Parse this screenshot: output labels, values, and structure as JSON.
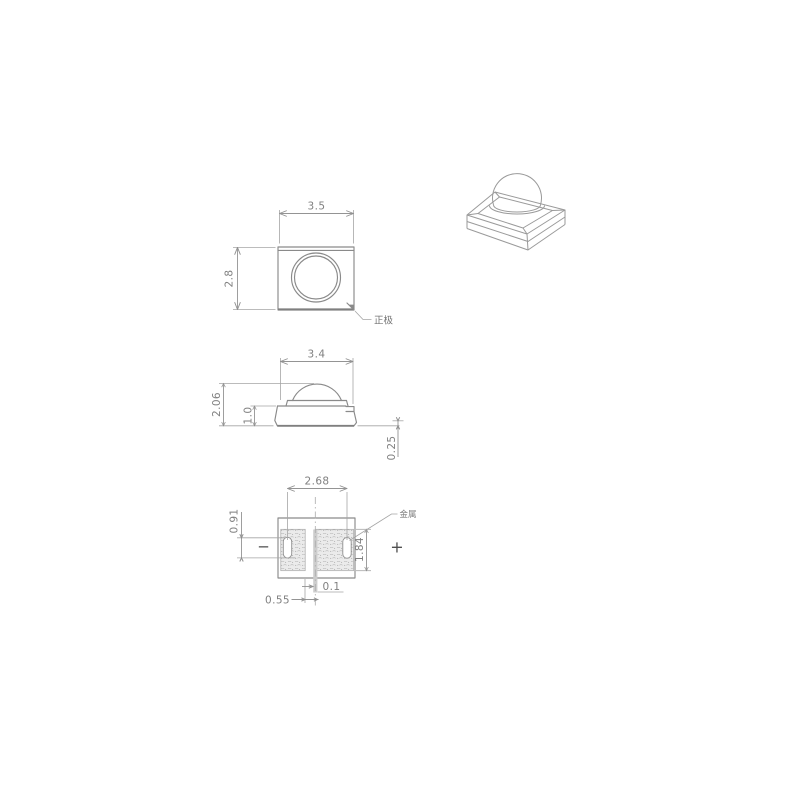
{
  "drawing": {
    "type": "smd-led-package-mechanical-drawing",
    "colors": {
      "line": "#8a8a8a",
      "dim_line": "#949494",
      "text": "#808080",
      "hatch_bg": "#ebebeb",
      "hatch_mark": "#b3b3b3",
      "slot_strip": "#cdcdcd",
      "background": "#ffffff"
    },
    "views": {
      "top_view": {
        "dim_width": "3.5",
        "dim_height": "2.8",
        "anode_label": "正极"
      },
      "side_view": {
        "dim_width": "3.4",
        "dim_total_height": "2.06",
        "dim_body_height": "1.0",
        "dim_standoff": "0.25"
      },
      "bottom_view": {
        "dim_pad_pitch": "2.68",
        "dim_slot_length": "0.91",
        "dim_pad_width": "1.84",
        "dim_pad_inset": "0.55",
        "dim_gap": "0.1",
        "metal_label": "金属",
        "polarity_minus": "−",
        "polarity_plus": "+"
      }
    }
  }
}
